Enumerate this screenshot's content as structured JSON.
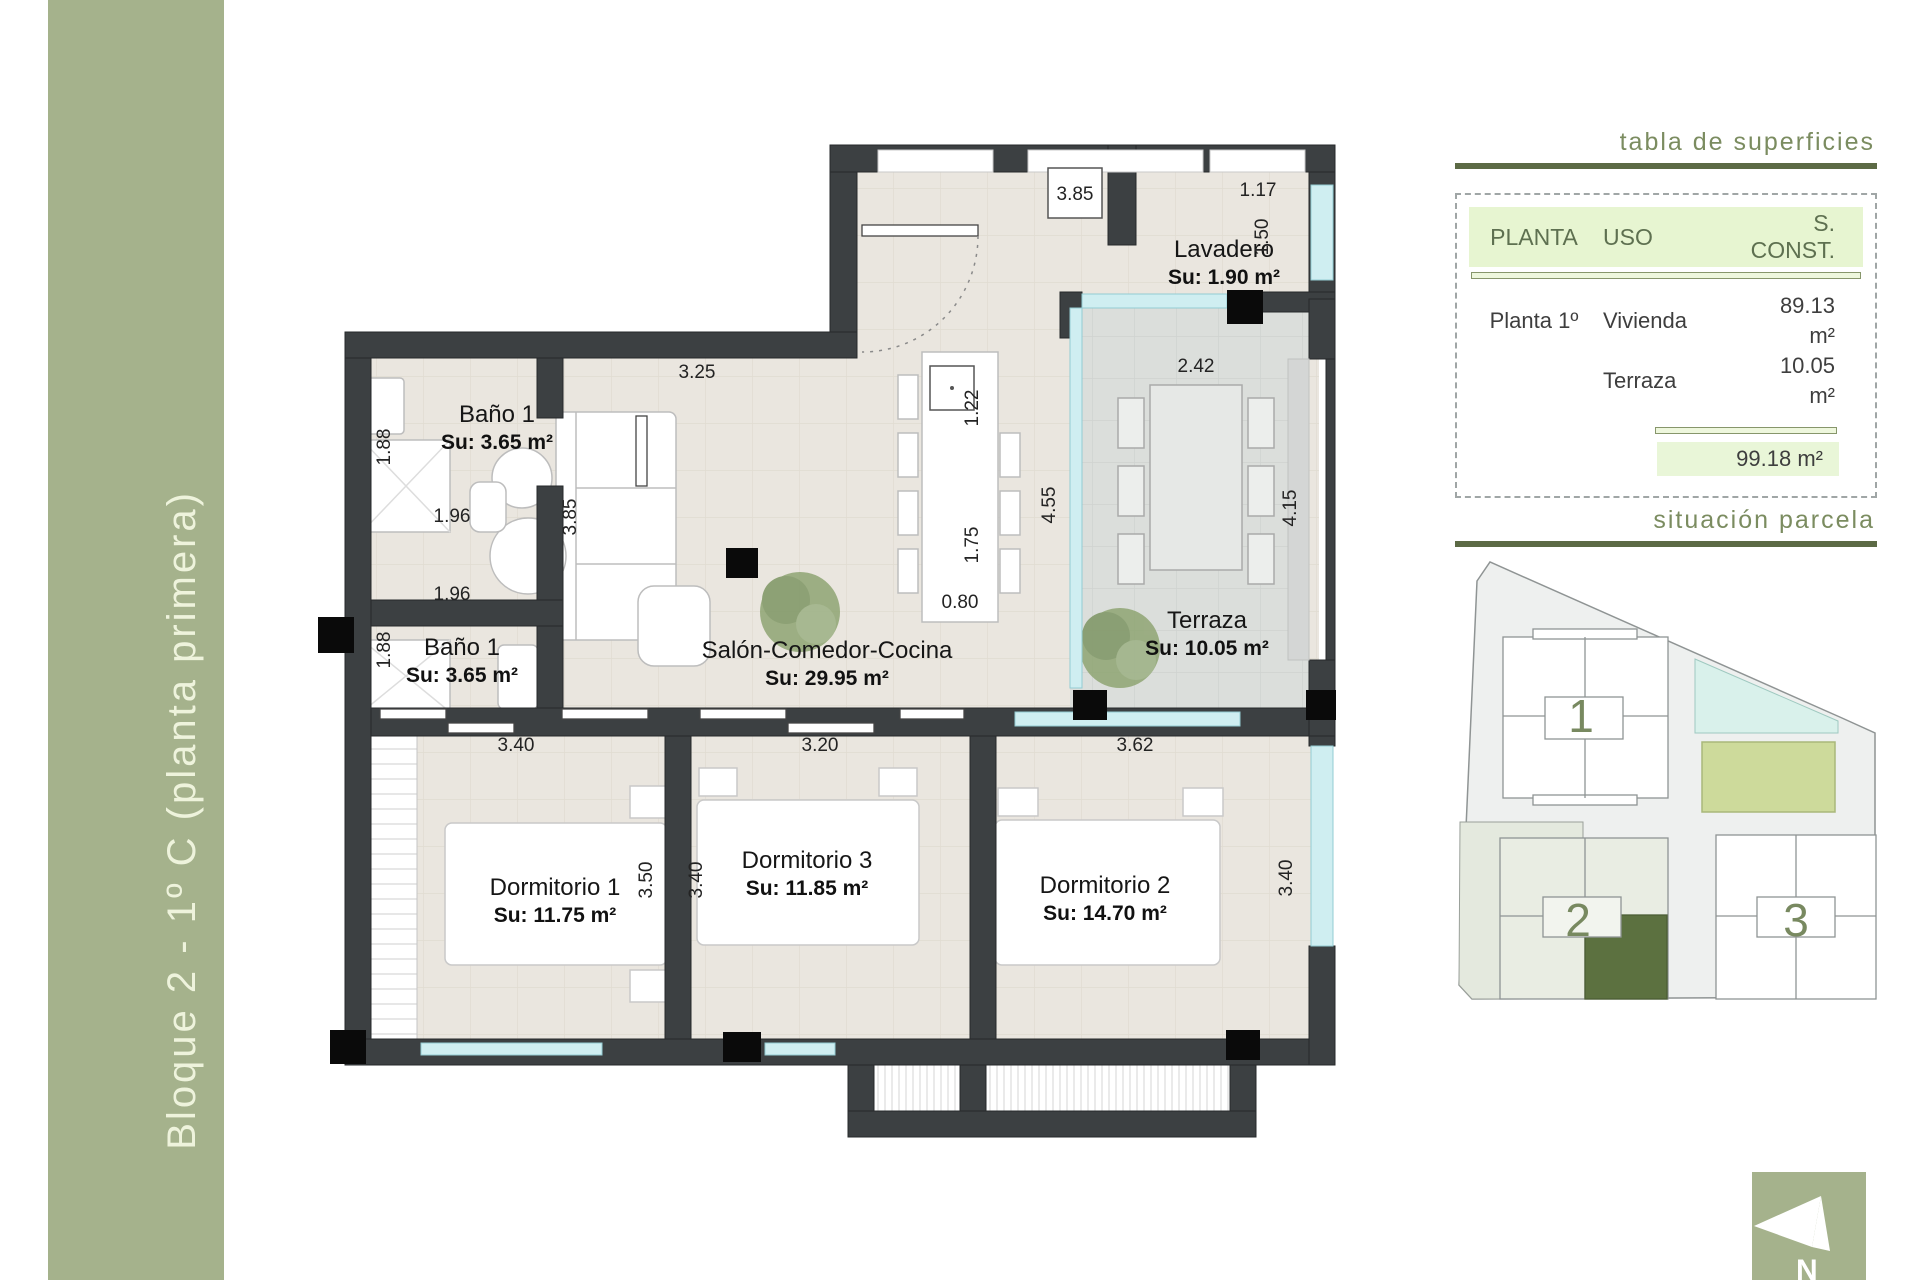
{
  "sidebar": {
    "title": "Bloque 2 - 1º C (planta primera)"
  },
  "plan": {
    "rooms": [
      {
        "name": "Baño 1",
        "area": "Su: 3.65 m²",
        "x": 497,
        "y": 422
      },
      {
        "name": "Baño 1",
        "area": "Su: 3.65 m²",
        "x": 462,
        "y": 655
      },
      {
        "name": "Lavadero",
        "area": "Su: 1.90 m²",
        "x": 1224,
        "y": 257
      },
      {
        "name": "Salón-Comedor-Cocina",
        "area": "Su: 29.95 m²",
        "x": 827,
        "y": 658
      },
      {
        "name": "Terraza",
        "area": "Su: 10.05 m²",
        "x": 1207,
        "y": 628
      },
      {
        "name": "Dormitorio 1",
        "area": "Su: 11.75 m²",
        "x": 555,
        "y": 895
      },
      {
        "name": "Dormitorio 3",
        "area": "Su: 11.85 m²",
        "x": 807,
        "y": 868
      },
      {
        "name": "Dormitorio 2",
        "area": "Su: 14.70 m²",
        "x": 1105,
        "y": 893
      }
    ],
    "dimensions": [
      {
        "text": "3.85",
        "x": 1075,
        "y": 200,
        "rot": 0
      },
      {
        "text": "1.17",
        "x": 1258,
        "y": 196,
        "rot": 0
      },
      {
        "text": "1.50",
        "x": 1268,
        "y": 237,
        "rot": -90
      },
      {
        "text": "3.25",
        "x": 697,
        "y": 378,
        "rot": 0
      },
      {
        "text": "1.88",
        "x": 390,
        "y": 447,
        "rot": -90
      },
      {
        "text": "1.96",
        "x": 452,
        "y": 522,
        "rot": 0
      },
      {
        "text": "3.85",
        "x": 576,
        "y": 517,
        "rot": -90
      },
      {
        "text": "1.88",
        "x": 390,
        "y": 650,
        "rot": -90
      },
      {
        "text": "1.96",
        "x": 452,
        "y": 600,
        "rot": 0
      },
      {
        "text": "1.22",
        "x": 978,
        "y": 408,
        "rot": -90
      },
      {
        "text": "1.75",
        "x": 978,
        "y": 545,
        "rot": -90
      },
      {
        "text": "0.80",
        "x": 960,
        "y": 608,
        "rot": 0
      },
      {
        "text": "4.55",
        "x": 1055,
        "y": 505,
        "rot": -90
      },
      {
        "text": "2.42",
        "x": 1196,
        "y": 372,
        "rot": 0
      },
      {
        "text": "4.15",
        "x": 1296,
        "y": 508,
        "rot": -90
      },
      {
        "text": "3.40",
        "x": 516,
        "y": 751,
        "rot": 0
      },
      {
        "text": "3.20",
        "x": 820,
        "y": 751,
        "rot": 0
      },
      {
        "text": "3.62",
        "x": 1135,
        "y": 751,
        "rot": 0
      },
      {
        "text": "3.50",
        "x": 652,
        "y": 880,
        "rot": -90
      },
      {
        "text": "3.40",
        "x": 702,
        "y": 880,
        "rot": -90
      },
      {
        "text": "3.40",
        "x": 1292,
        "y": 878,
        "rot": -90
      }
    ]
  },
  "surface_table": {
    "heading": "tabla de superficies",
    "columns": [
      "PLANTA",
      "USO",
      "S. CONST."
    ],
    "rows": [
      {
        "planta": "Planta 1º",
        "uso": "Vivienda",
        "sconst": "89.13 m²"
      },
      {
        "planta": "",
        "uso": "Terraza",
        "sconst": "10.05 m²"
      }
    ],
    "total": "99.18 m²"
  },
  "site_plan": {
    "heading": "situación parcela",
    "units": [
      {
        "label": "1",
        "x": 1581,
        "y": 732
      },
      {
        "label": "2",
        "x": 1578,
        "y": 936
      },
      {
        "label": "3",
        "x": 1796,
        "y": 936
      }
    ]
  },
  "north": {
    "label": "N"
  },
  "colors": {
    "sidebar_green": "#a5b28c",
    "wall_dark": "#3c4042",
    "accent_green": "#7b8c60",
    "rule_olive": "#5c6a45",
    "table_header_bg": "#e7f5d1",
    "total_bg": "#e9f6d8",
    "highlight_unit": "#5c7140",
    "lawn": "#cdda9b",
    "pool": "#d9f1eb",
    "window_glass": "#cfeef1"
  }
}
